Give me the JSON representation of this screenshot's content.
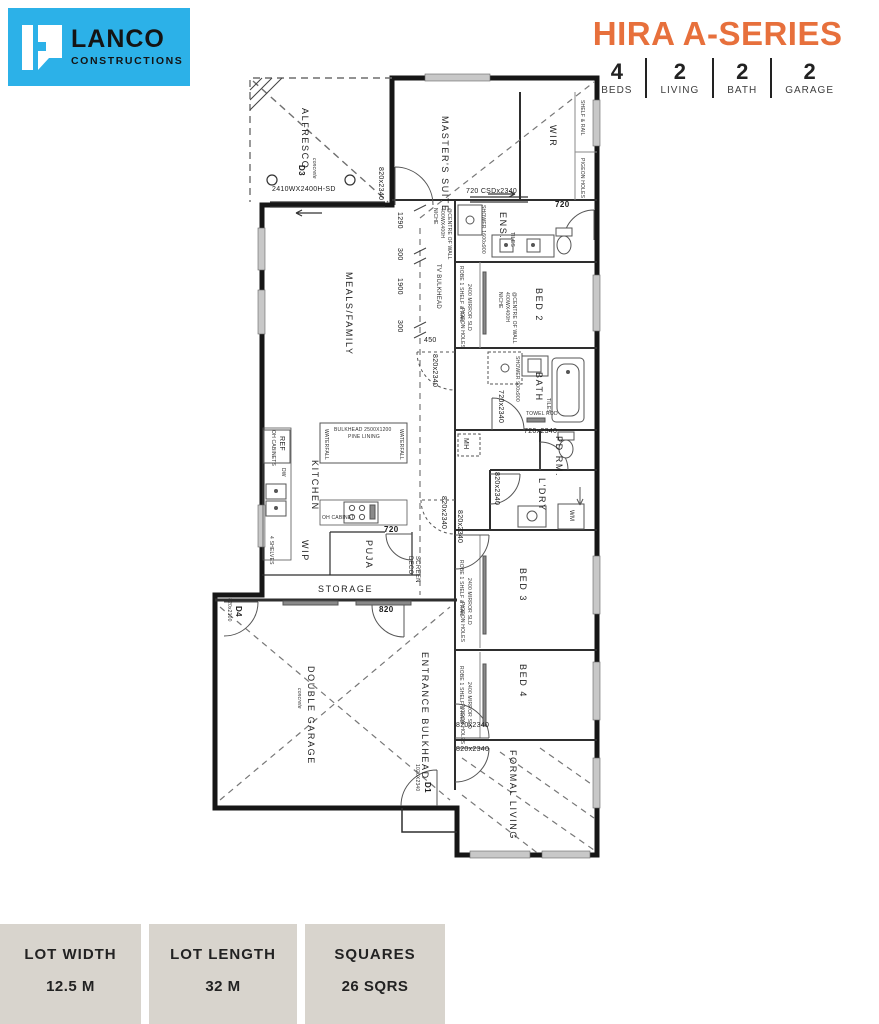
{
  "logo": {
    "name": "LANCO",
    "tagline": "CONSTRUCTIONS",
    "brand_color": "#2cb1e8"
  },
  "header": {
    "title": "HIRA A-SERIES",
    "title_color": "#e7703c",
    "stats": [
      {
        "value": "4",
        "label": "BEDS"
      },
      {
        "value": "2",
        "label": "LIVING"
      },
      {
        "value": "2",
        "label": "BATH"
      },
      {
        "value": "2",
        "label": "GARAGE"
      }
    ]
  },
  "plan": {
    "rooms": {
      "alfresco": "ALFRESCO",
      "masters": "MASTER'S SUITE",
      "wir": "WIR",
      "ens": "ENS.",
      "meals": "MEALS/FAMILY",
      "bed2": "BED 2",
      "bath": "BATH",
      "pd_rm": "PD RM.",
      "ldry": "L'DRY",
      "kitchen": "KITCHEN",
      "wip": "WIP",
      "puja": "PUJA",
      "storage": "STORAGE",
      "garage": "DOUBLE GARAGE",
      "garage_note": "concrete",
      "entrance": "ENTRANCE BULKHEAD",
      "bed3": "BED 3",
      "bed4": "BED 4",
      "formal": "FORMAL LIVING"
    },
    "features": {
      "shelf_rail": "SHELF & RAIL",
      "pigeon_holes": "PIGEON HOLES",
      "tv_bulkhead": "TV BULKHEAD",
      "deco_1": "DECO",
      "deco_2": "SCREEN",
      "robe": "ROBE 1 SHELF & RAIL",
      "mirror": "2400 MIRROR SLD",
      "towel_rod": "TOWEL ROD",
      "mh": "MH",
      "wm": "WM",
      "ref": "REF",
      "dw": "DW",
      "oh_cabinets": "OH CABINETS",
      "oh_cabinet": "OH CABINET",
      "shelves": "4 SHELVES",
      "island_1": "BULKHEAD 2500X1200",
      "island_2": "PINE LINING",
      "waterfall": "WATERFALL",
      "shower_ens": "SHOWER 1600x900",
      "shower_bath": "SHOWER 900x900",
      "niche_1": "NICHE",
      "niche_2": "400WX400H",
      "niche_3": "@CENTRE OF WALL",
      "tiles": "TILES"
    },
    "doors": {
      "d3": "D3",
      "d3_size": "2410WX2400H-SD",
      "d4": "D4",
      "d4_size": "820x2100",
      "d1": "D1",
      "d1_size": "1020X2340",
      "csd": "720 CSDx2340",
      "swing_820": "820x2340",
      "swing_720": "720x2340",
      "p720": "720",
      "g820": "820"
    },
    "dims": {
      "a": "1290",
      "b": "300",
      "c": "1900",
      "d": "300",
      "e": "450"
    }
  },
  "footer": {
    "boxes": [
      {
        "label": "LOT WIDTH",
        "value": "12.5 M"
      },
      {
        "label": "LOT LENGTH",
        "value": "32 M"
      },
      {
        "label": "SQUARES",
        "value": "26 SQRS"
      }
    ]
  }
}
